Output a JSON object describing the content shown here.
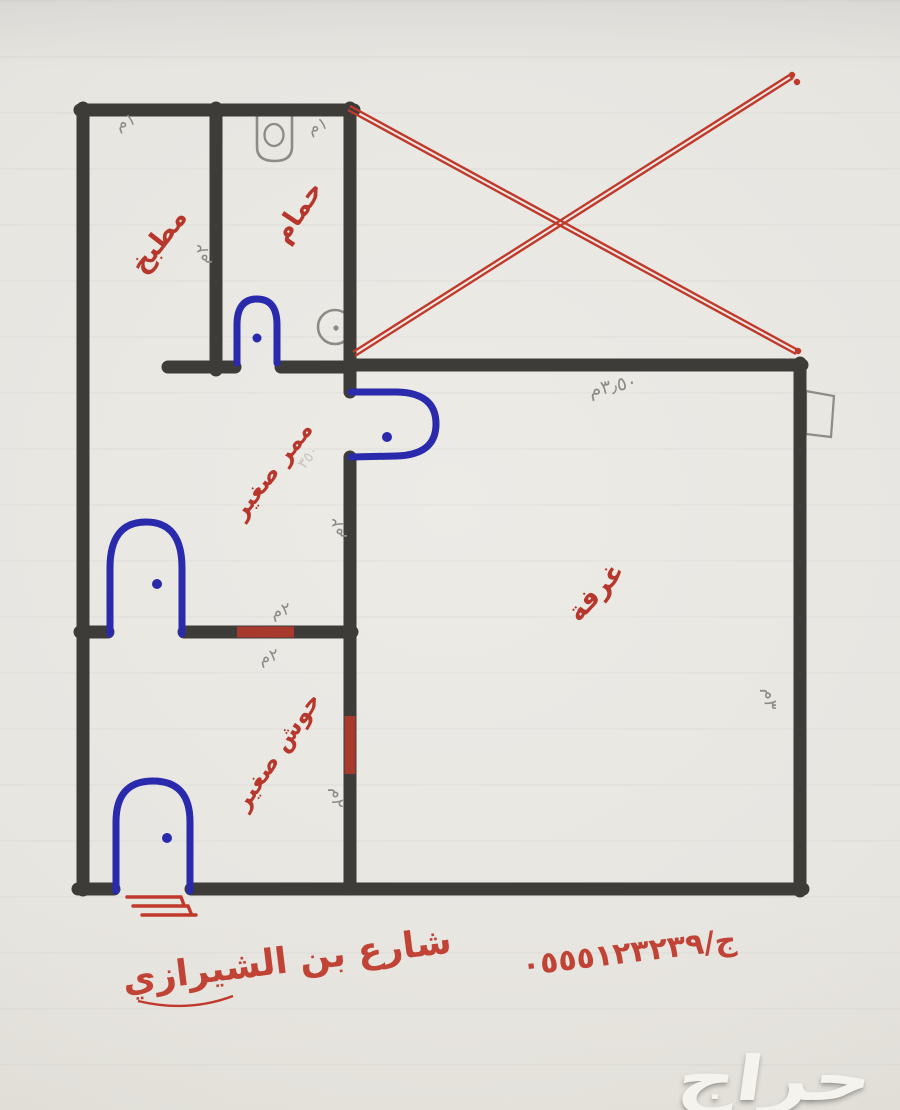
{
  "rooms": {
    "kitchen": "مطبخ",
    "bathroom": "حمام",
    "hallway": "ممر صغير",
    "room": "غرفة",
    "courtyard": "حوش صغير"
  },
  "dims": {
    "kitchen_width": "١م",
    "bathroom_width": "١م",
    "kitchen_height": "٢م",
    "top_width": "٣٫٥٠م",
    "hallway_height": "٢م",
    "inner_door_top": "٢م",
    "inner_door_bottom": "٢م",
    "yard_door": "٢م",
    "room_height": "٣م",
    "ghost": "٣٥٠"
  },
  "footer": {
    "street": "شارع بن الشيرازي",
    "phone": "ج/٠٥٥٥١٢٣٢٣٩"
  },
  "watermark": "حراج",
  "colors": {
    "wall": "#3e3c39",
    "door": "#2a2aad",
    "label": "#b7372c",
    "pencil": "#8d8b85",
    "cross": "#c0392b"
  }
}
